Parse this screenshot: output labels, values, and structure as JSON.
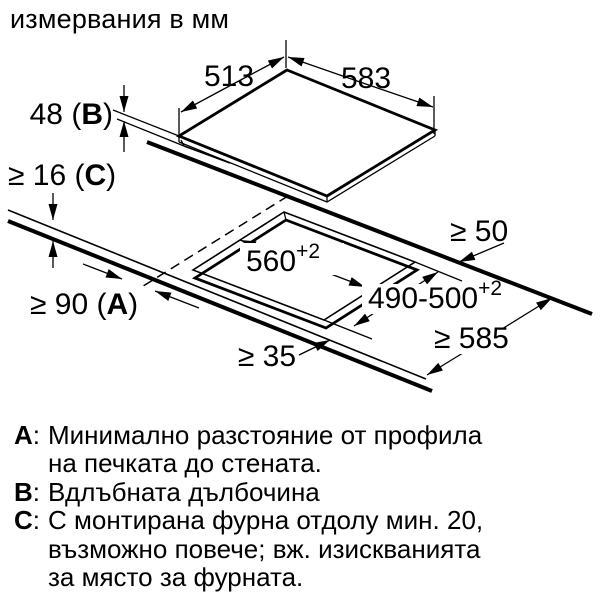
{
  "title": "измервания в мм",
  "colors": {
    "ink": "#000000",
    "bg": "#ffffff"
  },
  "diagram": {
    "unit_note": "mm",
    "dims": {
      "d513": "513",
      "d583": "583",
      "d48": {
        "pre": "48 (",
        "letter": "B",
        "post": ")"
      },
      "d16": {
        "pre": "≥ 16 (",
        "letter": "C",
        "post": ")"
      },
      "d90": {
        "pre": "≥ 90 (",
        "letter": "A",
        "post": ")"
      },
      "d50": "≥ 50",
      "d35": "≥ 35",
      "d585": "≥ 585",
      "d560": {
        "main": "560",
        "sup": "+2"
      },
      "d490": {
        "main": "490-500",
        "sup": "+2"
      }
    }
  },
  "legend": {
    "a": {
      "label": "A",
      "colon": ":",
      "line1": "Минимално разстояние от профила",
      "line2": "на печката до стената."
    },
    "b": {
      "label": "B",
      "colon": ":",
      "line1": "Вдлъбната дълбочина"
    },
    "c": {
      "label": "C",
      "colon": ":",
      "line1": "С монтирана фурна отдолу мин. 20,",
      "line2": "възможно повече; вж. изискванията",
      "line3": "за място за фурната."
    }
  }
}
